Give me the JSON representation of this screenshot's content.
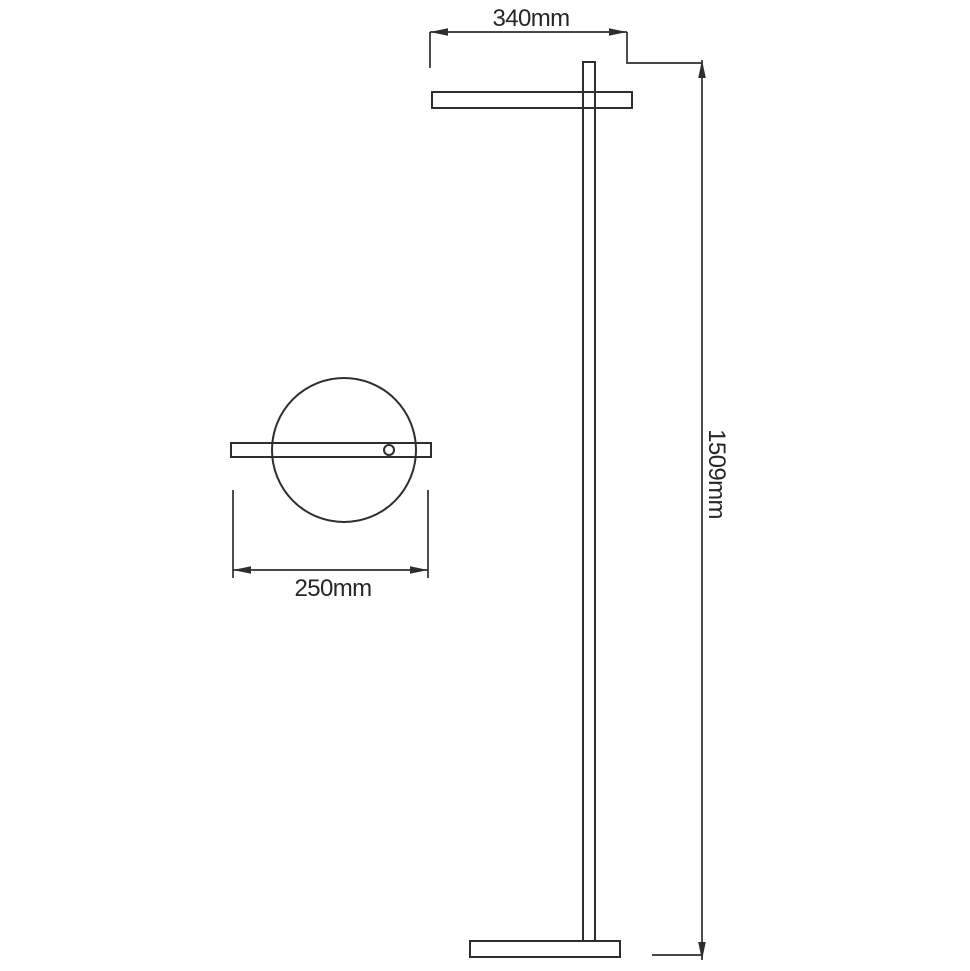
{
  "diagram": {
    "type": "technical-line-drawing",
    "subject": "floor-lamp-dimension-drawing",
    "dimensions": [
      {
        "id": "head-width-front",
        "label": "340mm"
      },
      {
        "id": "overall-height",
        "label": "1509mm"
      },
      {
        "id": "head-width-top-view",
        "label": "250mm"
      }
    ],
    "colors": {
      "line": "#2e2e2e",
      "text": "#262626",
      "background": "#ffffff"
    }
  }
}
